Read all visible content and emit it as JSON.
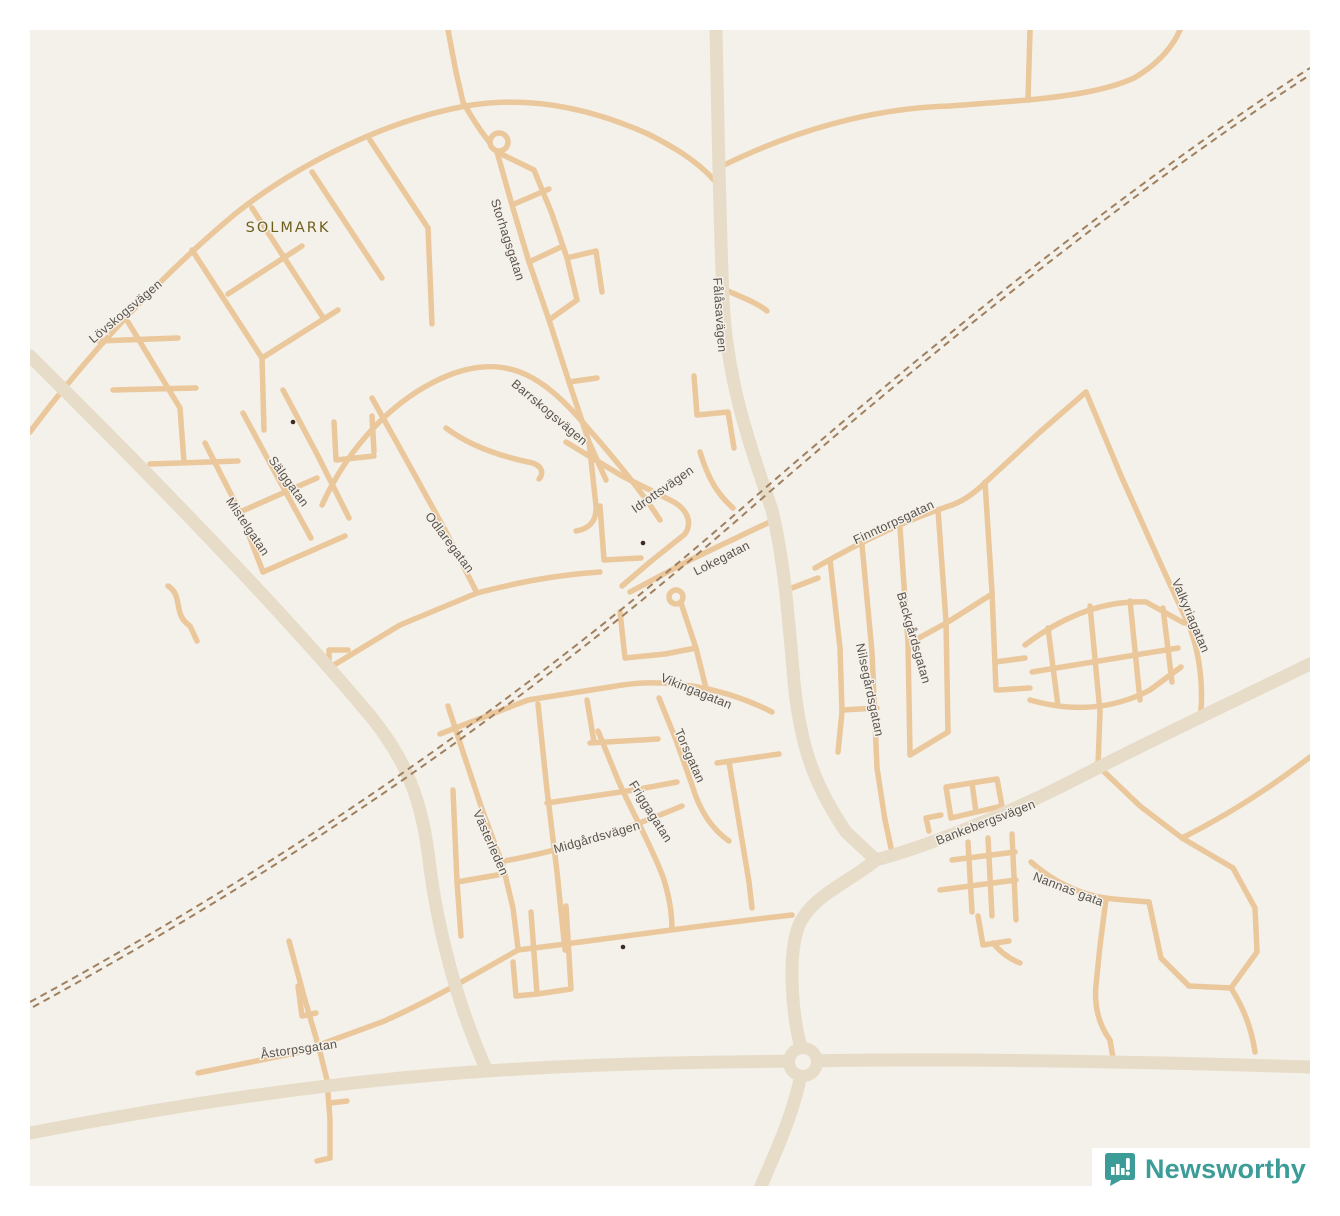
{
  "map": {
    "page_background": "#ffffff",
    "background": "#f4f1ea",
    "colors": {
      "road_minor": "#ebc79c",
      "road_major": "#e7dcc8",
      "railway": "#9f7f5e",
      "street_label": "#5b534b",
      "locality_label": "#6f5f1d",
      "poi_dot": "#3c2b21"
    },
    "locality_labels": [
      {
        "name": "SOLMARK",
        "x": 288,
        "y": 228,
        "rotation": 0
      }
    ],
    "street_labels": [
      {
        "name": "Lövskogsvägen",
        "x": 126,
        "y": 312,
        "rotation": -40
      },
      {
        "name": "Storhagsgatan",
        "x": 507,
        "y": 240,
        "rotation": 72
      },
      {
        "name": "Fålåsavägen",
        "x": 719,
        "y": 315,
        "rotation": 86
      },
      {
        "name": "Barrskogsvägen",
        "x": 549,
        "y": 413,
        "rotation": 40
      },
      {
        "name": "Sälggatan",
        "x": 288,
        "y": 482,
        "rotation": 54
      },
      {
        "name": "Mistelgatan",
        "x": 247,
        "y": 527,
        "rotation": 56
      },
      {
        "name": "Odlaregatan",
        "x": 449,
        "y": 543,
        "rotation": 53
      },
      {
        "name": "Idrottsvägen",
        "x": 663,
        "y": 490,
        "rotation": -35
      },
      {
        "name": "Lokegatan",
        "x": 722,
        "y": 559,
        "rotation": -27
      },
      {
        "name": "Finntorpsgatan",
        "x": 894,
        "y": 523,
        "rotation": -25
      },
      {
        "name": "Backgårdsgatan",
        "x": 913,
        "y": 638,
        "rotation": 74
      },
      {
        "name": "Nilsegårdsgatan",
        "x": 869,
        "y": 690,
        "rotation": 78
      },
      {
        "name": "Vikingagatan",
        "x": 696,
        "y": 692,
        "rotation": 22
      },
      {
        "name": "Torsgatan",
        "x": 689,
        "y": 756,
        "rotation": 66
      },
      {
        "name": "Friggagatan",
        "x": 650,
        "y": 812,
        "rotation": 58
      },
      {
        "name": "Midgårdsvägen",
        "x": 597,
        "y": 838,
        "rotation": -16
      },
      {
        "name": "Västerleden",
        "x": 490,
        "y": 843,
        "rotation": 66
      },
      {
        "name": "Bankebergsvägen",
        "x": 986,
        "y": 823,
        "rotation": -21
      },
      {
        "name": "Nannas gata",
        "x": 1068,
        "y": 890,
        "rotation": 21
      },
      {
        "name": "Valkyriagatan",
        "x": 1190,
        "y": 616,
        "rotation": 67
      },
      {
        "name": "Åstorpsgatan",
        "x": 299,
        "y": 1050,
        "rotation": -8
      }
    ],
    "poi_dots": [
      {
        "x": 293,
        "y": 422
      },
      {
        "x": 643,
        "y": 543
      },
      {
        "x": 623,
        "y": 947
      }
    ]
  },
  "attribution": {
    "brand": "Newsworthy",
    "color": "#3b9c98",
    "icon": "newsworthy-bar-chart-badge"
  }
}
